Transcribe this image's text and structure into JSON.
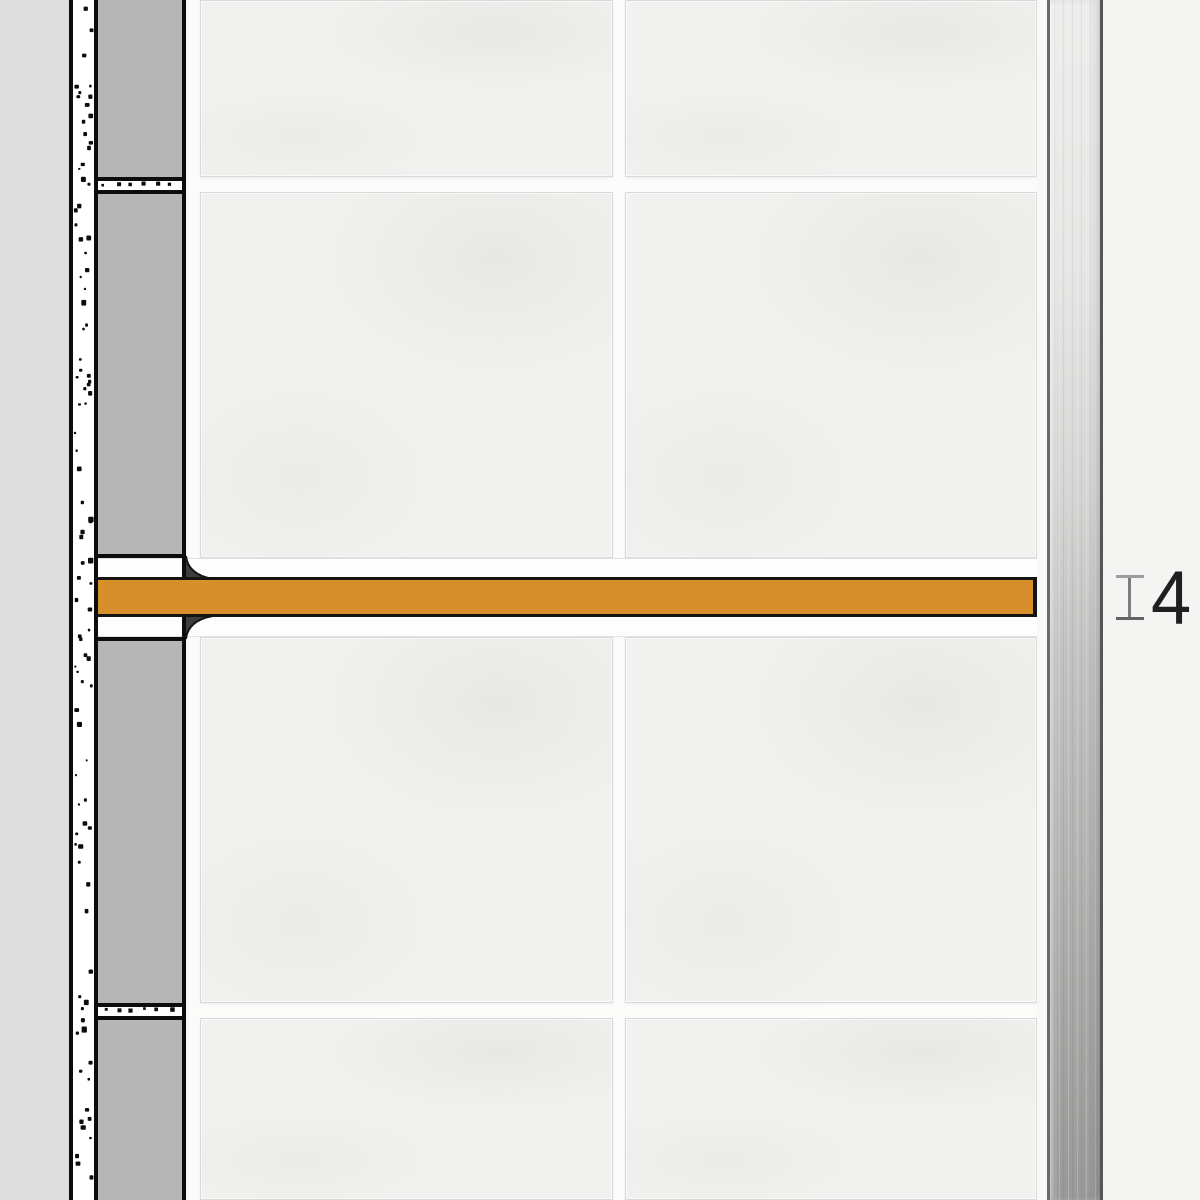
{
  "annotation": {
    "dimension_value": "4"
  },
  "colors": {
    "product_accent_orange": "#d78f2c",
    "outline_black": "#0d0d0d",
    "tile_section_gray": "#b6b6b6",
    "wall_substrate_gray": "#dddddd",
    "tile_face_white": "#f1f1ef",
    "grout_white": "#fbfbfa",
    "adhesive_fillet_gray": "#3d3d3d",
    "metal_profile_light": "#ededec",
    "metal_profile_dark": "#999998",
    "background_gray": "#f4f4f3",
    "dimension_marker_gray": "#7c7c7c",
    "dimension_text_color": "#1f1f1f"
  },
  "icons": {
    "dimension_extent": "vertical-extent-I-marker"
  }
}
